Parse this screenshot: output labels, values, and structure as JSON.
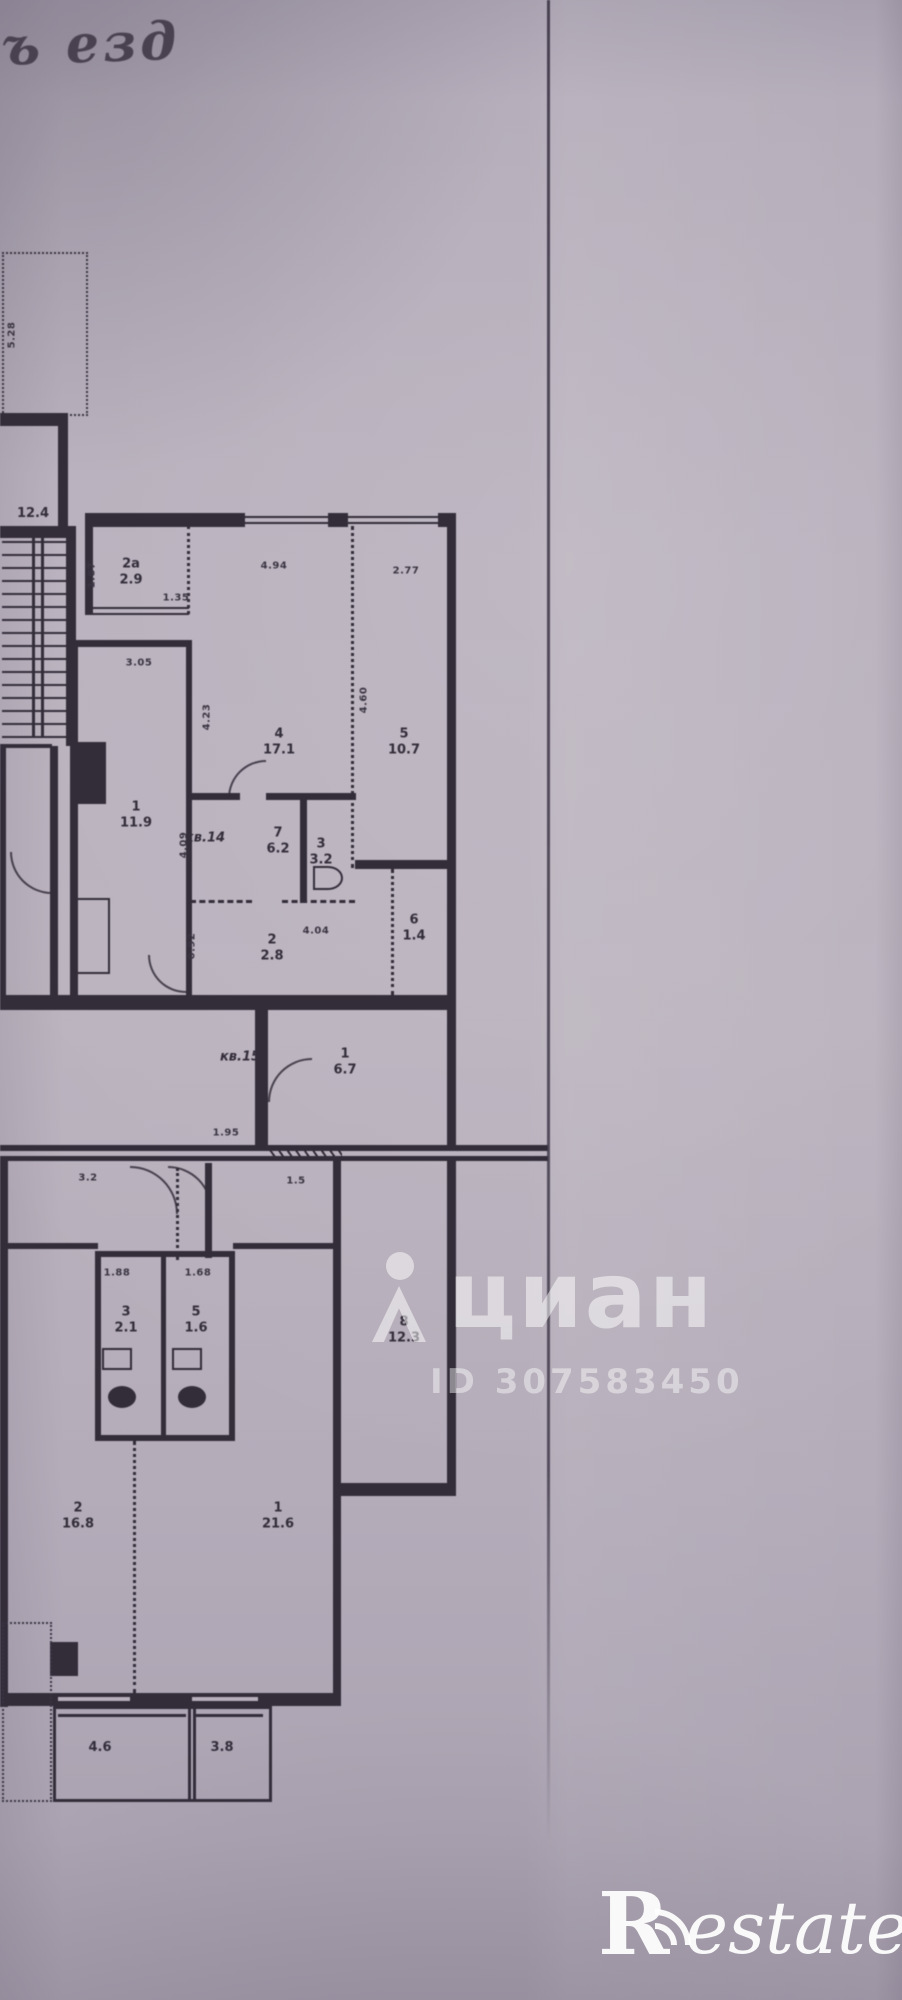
{
  "handwriting": {
    "text": "ъ езд"
  },
  "watermark": {
    "brand": "циан",
    "id": "ID 307583450"
  },
  "logo": {
    "letter": "R",
    "word": "estate"
  },
  "floorplan": {
    "apartments": [
      {
        "number_label": "кв.14",
        "x": 205,
        "y": 838
      },
      {
        "number_label": "кв.15",
        "x": 240,
        "y": 1057
      }
    ],
    "room_labels": [
      {
        "num": "2а",
        "area": "2.9",
        "x": 131,
        "y": 572
      },
      {
        "num": "1",
        "area": "11.9",
        "x": 136,
        "y": 815
      },
      {
        "num": "4",
        "area": "17.1",
        "x": 279,
        "y": 742
      },
      {
        "num": "5",
        "area": "10.7",
        "x": 404,
        "y": 742
      },
      {
        "num": "7",
        "area": "6.2",
        "x": 278,
        "y": 841
      },
      {
        "num": "3",
        "area": "3.2",
        "x": 321,
        "y": 852
      },
      {
        "num": "2",
        "area": "2.8",
        "x": 272,
        "y": 948
      },
      {
        "num": "6",
        "area": "1.4",
        "x": 414,
        "y": 928
      },
      {
        "num": "1",
        "area": "6.7",
        "x": 345,
        "y": 1062
      },
      {
        "num": "8",
        "area": "12.3",
        "x": 404,
        "y": 1330
      },
      {
        "num": "1",
        "area": "21.6",
        "x": 278,
        "y": 1516
      },
      {
        "num": "2",
        "area": "16.8",
        "x": 78,
        "y": 1516
      },
      {
        "num": "3",
        "area": "2.1",
        "x": 126,
        "y": 1320
      },
      {
        "num": "5",
        "area": "1.6",
        "x": 196,
        "y": 1320
      },
      {
        "num": "",
        "area": "12.4",
        "x": 33,
        "y": 514
      },
      {
        "num": "",
        "area": "4.6",
        "x": 100,
        "y": 1748
      },
      {
        "num": "",
        "area": "3.8",
        "x": 222,
        "y": 1748
      }
    ],
    "dimension_labels": [
      {
        "text": "5.28",
        "x": 12,
        "y": 335,
        "v": true
      },
      {
        "text": "1.87",
        "x": 92,
        "y": 575,
        "v": true
      },
      {
        "text": "1.35",
        "x": 176,
        "y": 598,
        "v": false
      },
      {
        "text": "3.05",
        "x": 139,
        "y": 663,
        "v": false
      },
      {
        "text": "4.94",
        "x": 274,
        "y": 566,
        "v": false
      },
      {
        "text": "2.77",
        "x": 406,
        "y": 571,
        "v": false
      },
      {
        "text": "4.23",
        "x": 207,
        "y": 717,
        "v": true
      },
      {
        "text": "4.60",
        "x": 364,
        "y": 700,
        "v": true
      },
      {
        "text": "4.09",
        "x": 184,
        "y": 845,
        "v": true
      },
      {
        "text": "0.92",
        "x": 192,
        "y": 946,
        "v": true
      },
      {
        "text": "4.04",
        "x": 316,
        "y": 931,
        "v": false
      },
      {
        "text": "1.88",
        "x": 117,
        "y": 1273,
        "v": false
      },
      {
        "text": "1.68",
        "x": 198,
        "y": 1273,
        "v": false
      },
      {
        "text": "1.95",
        "x": 226,
        "y": 1133,
        "v": false
      },
      {
        "text": "1.5",
        "x": 296,
        "y": 1181,
        "v": false
      },
      {
        "text": "3.2",
        "x": 88,
        "y": 1178,
        "v": false
      }
    ]
  }
}
